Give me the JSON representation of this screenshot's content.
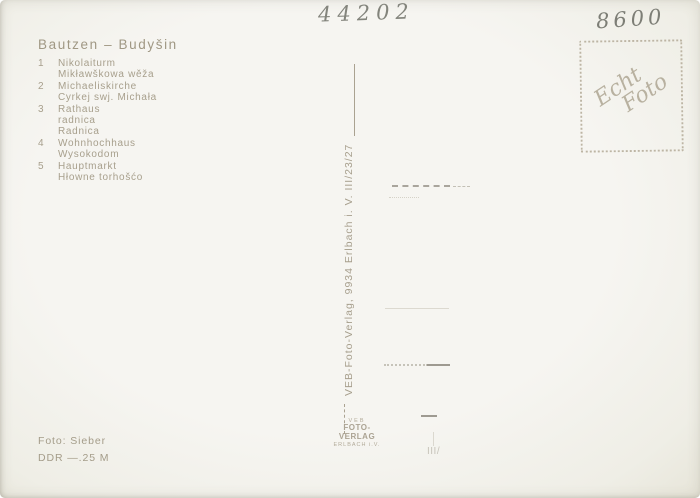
{
  "card": {
    "title": "Bautzen – Budyšin",
    "legend": [
      {
        "num": "1",
        "lines": [
          "Nikolaiturm",
          "Mikławškowa wěža"
        ]
      },
      {
        "num": "2",
        "lines": [
          "Michaeliskirche",
          "Cyrkej swj. Michała"
        ]
      },
      {
        "num": "3",
        "lines": [
          "Rathaus",
          "radnica",
          "Radnica"
        ]
      },
      {
        "num": "4",
        "lines": [
          "Wohnhochhaus",
          "Wysokodom"
        ]
      },
      {
        "num": "5",
        "lines": [
          "Hauptmarkt",
          "Hłowne torhošćo"
        ]
      }
    ],
    "handwritten_center": "44202",
    "handwritten_right": "8600",
    "stamp": {
      "line1": "Echt",
      "line2": "Foto"
    },
    "publisher_vertical": "VEB-Foto-Verlag, 9934 Erlbach i. V. III/23/27",
    "logo": {
      "veb": "VEB",
      "name": "FOTO-VERLAG",
      "city": "ERLBACH i.V."
    },
    "photo_credit": "Foto: Sieber",
    "price": "DDR —.25 M",
    "faint_mark": "III/",
    "colors": {
      "background": "#f4f3ee",
      "print": "#a79f8c",
      "pencil": "#83847c",
      "stamp": "#b8b1a0"
    }
  }
}
